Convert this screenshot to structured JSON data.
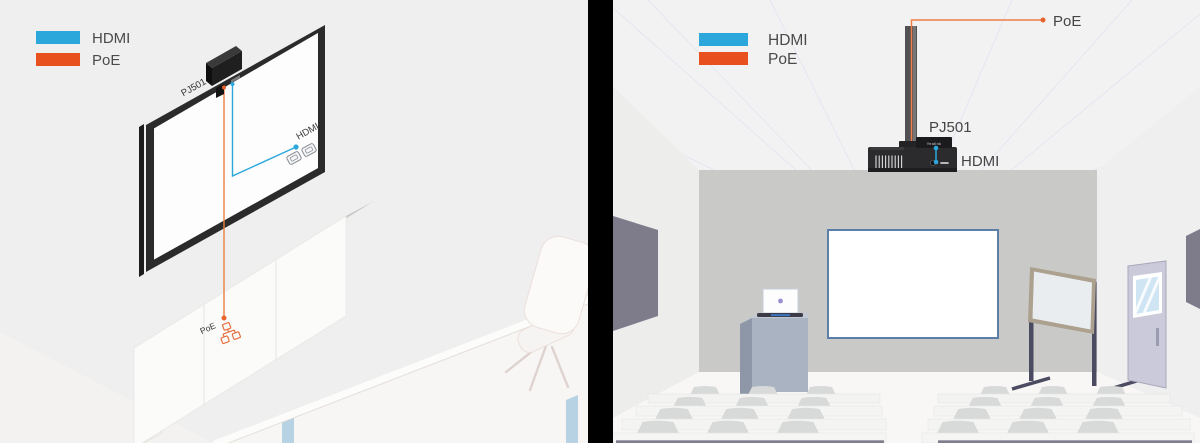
{
  "colors": {
    "hdmi_blue": "#2BA7DC",
    "poe_orange": "#E8511D",
    "cable_orange": "#EE7E48",
    "cable_blue": "#2BA7DC",
    "dot_orange": "#E8622D",
    "label_text": "#454545"
  },
  "left_scene": {
    "legend": [
      {
        "label": "HDMI"
      },
      {
        "label": "PoE"
      }
    ],
    "labels": {
      "device": "PJ501",
      "hdmi_port": "HDMI",
      "poe_outlet": "PoE"
    }
  },
  "right_scene": {
    "legend": [
      {
        "label": "HDMI"
      },
      {
        "label": "PoE"
      }
    ],
    "labels": {
      "poe_drop": "PoE",
      "device": "PJ501",
      "hdmi_port": "HDMI",
      "device_brand": "Yealink"
    }
  }
}
